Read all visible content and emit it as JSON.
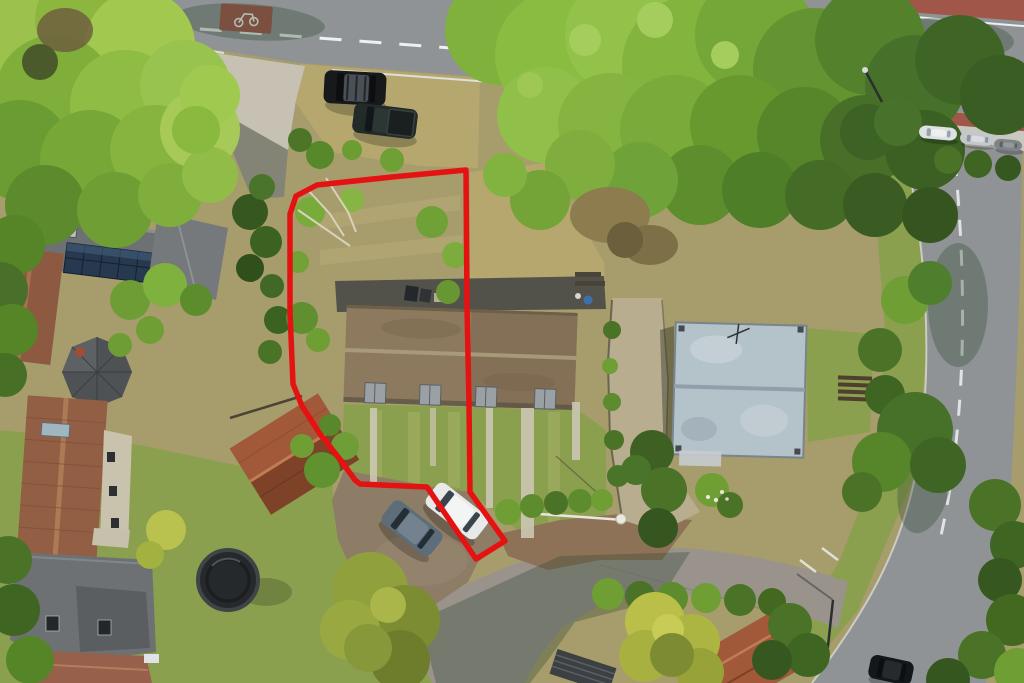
{
  "meta": {
    "description": "Aerial drone photograph of a residential property listing; a red outline marks the plot boundary around one half of a semi-detached house, its rear garden and a parking bay",
    "image_type": "aerial-photo",
    "width": 1024,
    "height": 683
  },
  "palette": {
    "boundary_red": "#e41312",
    "road_asphalt": "#8f9395",
    "road_warm": "#99938b",
    "curb_light": "#c9c8c0",
    "marking_white": "#edf1f1",
    "cycle_lane_red": "#a05648",
    "concrete_drive": "#c6c1b2",
    "gravel": "#b9ad90",
    "dirt_parking": "#8d7c66",
    "grass_lawn": "#8ba04e",
    "grass_dry": "#b5a76e",
    "scrub": "#a79c6b",
    "tree_bright": "#8fbc45",
    "tree_mid": "#6f9e35",
    "tree_dark": "#4a7327",
    "tree_deep": "#365820",
    "bush_yellow": "#b9bf48",
    "roof_semi": "#8d7a5e",
    "roof_semi_right": "#847056",
    "roof_flat": "#b4c2ca",
    "roof_slate": "#6d7173",
    "roof_redbrown": "#925f45",
    "roof_rust": "#a2593a",
    "solar_panel": "#27394f",
    "shadow_dark": "rgba(25,35,22,0.38)"
  },
  "boundary": {
    "color": "#e41312",
    "stroke_width": 5.5,
    "points": [
      [
        466,
        170
      ],
      [
        392,
        177
      ],
      [
        317,
        185
      ],
      [
        296,
        196
      ],
      [
        290,
        214
      ],
      [
        290,
        312
      ],
      [
        293,
        384
      ],
      [
        302,
        406
      ],
      [
        320,
        434
      ],
      [
        342,
        462
      ],
      [
        355,
        480
      ],
      [
        360,
        484
      ],
      [
        427,
        487
      ],
      [
        476,
        559
      ],
      [
        505,
        541
      ],
      [
        470,
        492
      ],
      [
        469,
        404
      ],
      [
        467,
        308
      ]
    ]
  },
  "vehicles": [
    {
      "name": "black-suv-top",
      "type": "suv",
      "cx": 355,
      "cy": 88,
      "w": 62,
      "h": 33,
      "angle": 3,
      "body": "#17191b",
      "glass": "#0d0e10",
      "roof": "#4a5156"
    },
    {
      "name": "dark-pickup-top",
      "type": "pickup",
      "cx": 385,
      "cy": 121,
      "w": 64,
      "h": 30,
      "angle": 7,
      "body": "#232b29",
      "glass": "#11161a",
      "roof": "#2c3634",
      "bed": "#1a201f"
    },
    {
      "name": "grey-car-parking",
      "type": "car",
      "cx": 412,
      "cy": 528,
      "w": 62,
      "h": 29,
      "angle": 38,
      "body": "#5d6d79",
      "glass": "#252e34",
      "roof": "#73828e"
    },
    {
      "name": "white-car-parking",
      "type": "car",
      "cx": 457,
      "cy": 511,
      "w": 64,
      "h": 29,
      "angle": 38,
      "body": "#e8eaea",
      "glass": "#39444c",
      "roof": "#f3f5f5"
    },
    {
      "name": "dark-car-road",
      "type": "car",
      "cx": 891,
      "cy": 670,
      "w": 44,
      "h": 24,
      "angle": 12,
      "body": "#141719",
      "glass": "#0c0e10",
      "roof": "#252a2e"
    },
    {
      "name": "parked-white-street",
      "type": "car",
      "cx": 938,
      "cy": 133,
      "w": 38,
      "h": 13,
      "angle": 5,
      "body": "#dde1e3",
      "glass": "#9aa2a8",
      "roof": "#eef0f0"
    },
    {
      "name": "parked-silver-street",
      "type": "car",
      "cx": 977,
      "cy": 139,
      "w": 34,
      "h": 12,
      "angle": 5,
      "body": "#c3c8cc",
      "glass": "#8d959b",
      "roof": "#d8dcde"
    },
    {
      "name": "parked-grey-street",
      "type": "car",
      "cx": 1008,
      "cy": 145,
      "w": 28,
      "h": 11,
      "angle": 5,
      "body": "#7e8487",
      "glass": "#5b6165",
      "roof": "#94999c"
    }
  ],
  "scene_objects": [
    "main-road-top",
    "red-cycle-lanes",
    "white-lane-markings",
    "hatched-bay-markings",
    "bicycle-symbol",
    "street-lamp",
    "plot-garden-scrub",
    "semi-detached-house-roof",
    "roof-dormers",
    "rear-yard-with-bins",
    "flat-roof-outbuilding",
    "gravel-driveway",
    "concrete-driveway",
    "parking-area-two-cars",
    "cul-de-sac-road",
    "brick-lane",
    "left-house-with-solar-panels",
    "octagonal-turret-roof",
    "long-red-tiled-roof",
    "slate-roof-house",
    "red-tiled-outbuilding",
    "trampoline",
    "mature-tree-canopies",
    "yellow-green-bushes",
    "right-curving-street",
    "property-boundary-overlay"
  ]
}
